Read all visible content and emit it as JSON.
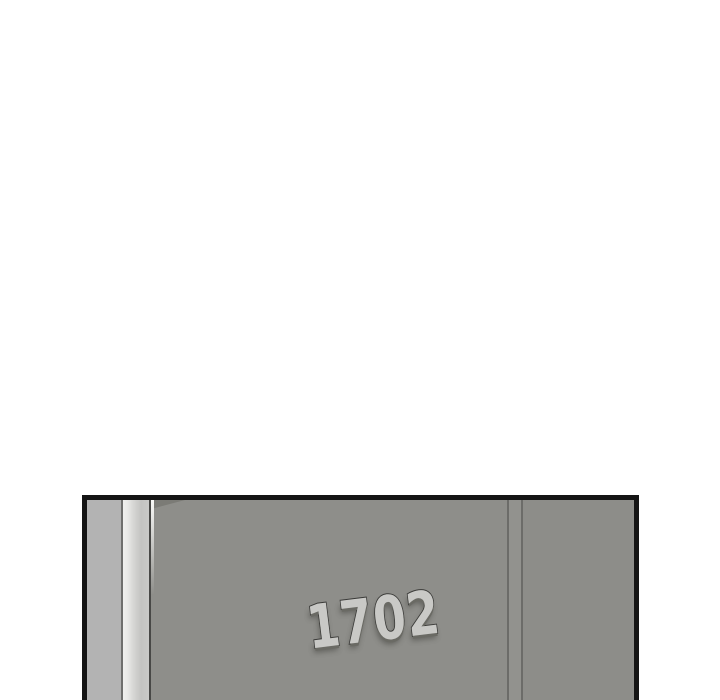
{
  "page": {
    "type": "comic-panel-page",
    "background_color": "#ffffff"
  },
  "panel": {
    "description": "apartment hallway door close-up",
    "door_number": "1702",
    "border_color": "#141414",
    "colors": {
      "wall_left": "#b3b3b3",
      "frame_strip_highlight": "#f0f0ee",
      "frame_strip_shade": "#c3c3c1",
      "door_face": "#8e8e8a",
      "door_edge_line": "#484846",
      "seam_line": "#6c6c69",
      "jamb_strip": "#92928e",
      "wall_right": "#8d8d89",
      "number_fill": "#c9c9c6",
      "number_outline": "#3b3b39"
    }
  }
}
